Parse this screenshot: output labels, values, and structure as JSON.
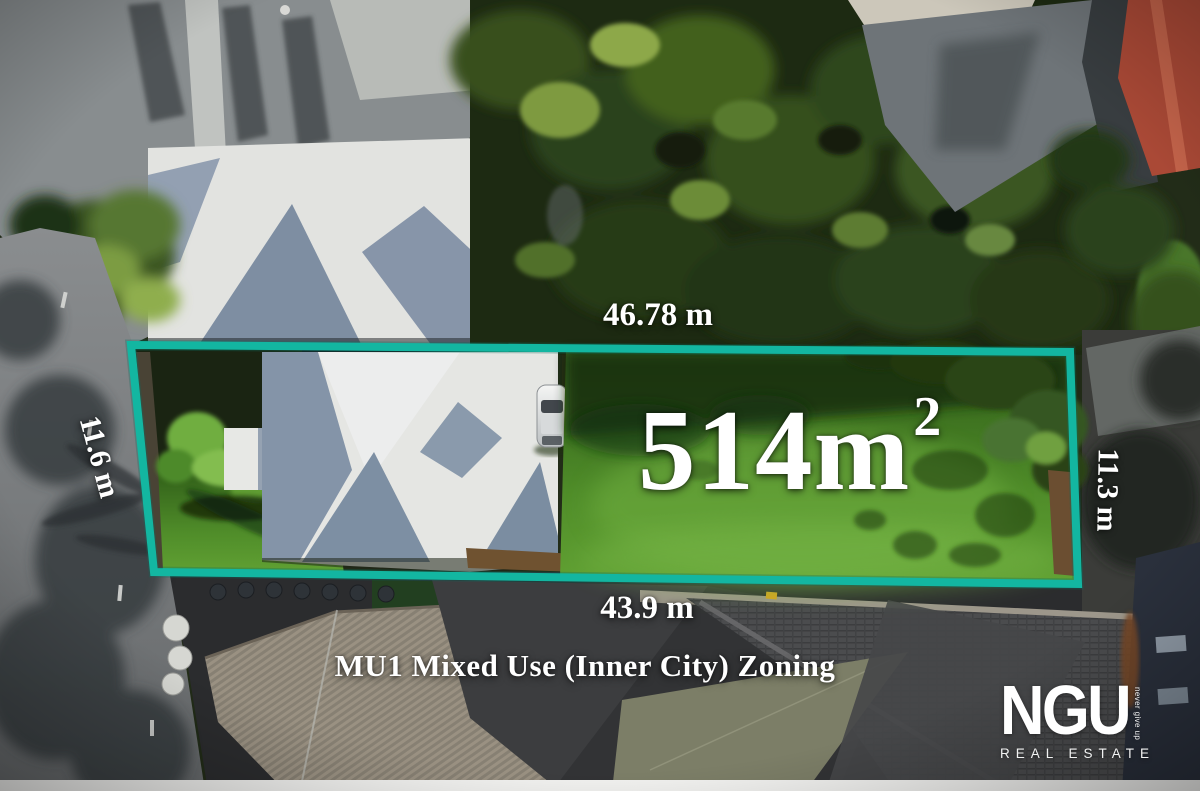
{
  "annotations": {
    "top_dimension": "46.78 m",
    "left_dimension": "11.6 m",
    "right_dimension": "11.3 m",
    "bottom_dimension": "43.9 m",
    "area_main": "514m",
    "area_superscript": "2",
    "zoning_text": "MU1 Mixed Use (Inner City) Zoning"
  },
  "logo": {
    "brand": "NGU",
    "tagline": "never give up",
    "division": "REAL ESTATE"
  },
  "colors": {
    "boundary_teal": "#13b6a1",
    "label_white": "#ffffff",
    "lawn_green": "#4f8c29",
    "roof_white": "#e5e6e3",
    "roof_slate": "#8494a8"
  }
}
